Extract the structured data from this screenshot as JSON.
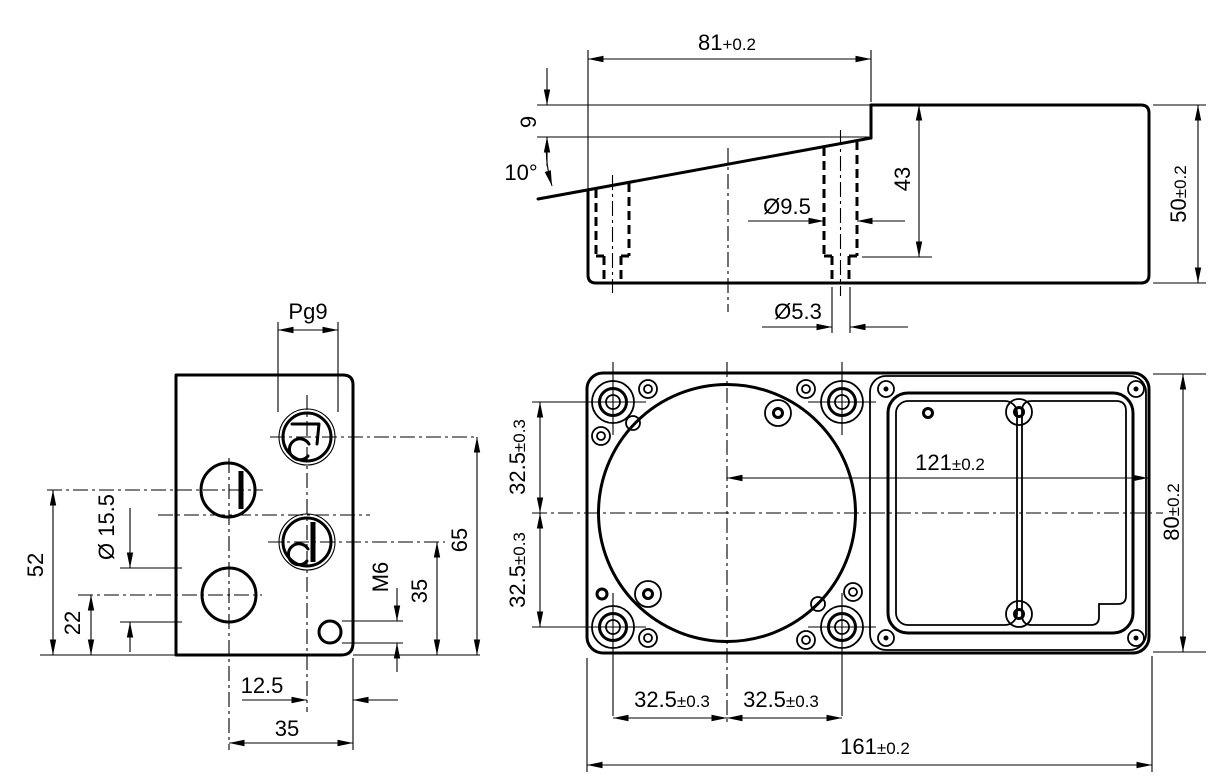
{
  "drawing": {
    "side_view": {
      "dims": {
        "top_width": {
          "value": "81",
          "tol": "+0.2"
        },
        "step_height": "9",
        "slope_angle": "10°",
        "counterbore_dia": "Ø9.5",
        "hole_depth": "43",
        "through_dia": "Ø5.3",
        "overall_height": {
          "value": "50",
          "tol": "±0.2"
        }
      }
    },
    "end_view": {
      "dims": {
        "gland_thread": "Pg9",
        "side_hole_dia": "Ø 15.5",
        "upper_hole_height": "52",
        "lower_hole_height": "22",
        "gland_edge_offset": "12.5",
        "gland_center_offset": "35",
        "screw_thread": "M6",
        "lower_gland_height": "35",
        "upper_gland_height": "65"
      }
    },
    "plan_view": {
      "dims": {
        "pitch_left_upper": {
          "value": "32.5",
          "tol": "±0.3"
        },
        "pitch_left_lower": {
          "value": "32.5",
          "tol": "±0.3"
        },
        "pitch_bottom_left": {
          "value": "32.5",
          "tol": "±0.3"
        },
        "pitch_bottom_right": {
          "value": "32.5",
          "tol": "±0.3"
        },
        "center_to_right_edge": {
          "value": "121",
          "tol": "±0.2"
        },
        "overall_width": {
          "value": "80",
          "tol": "±0.2"
        },
        "overall_length": {
          "value": "161",
          "tol": "±0.2"
        }
      }
    }
  }
}
